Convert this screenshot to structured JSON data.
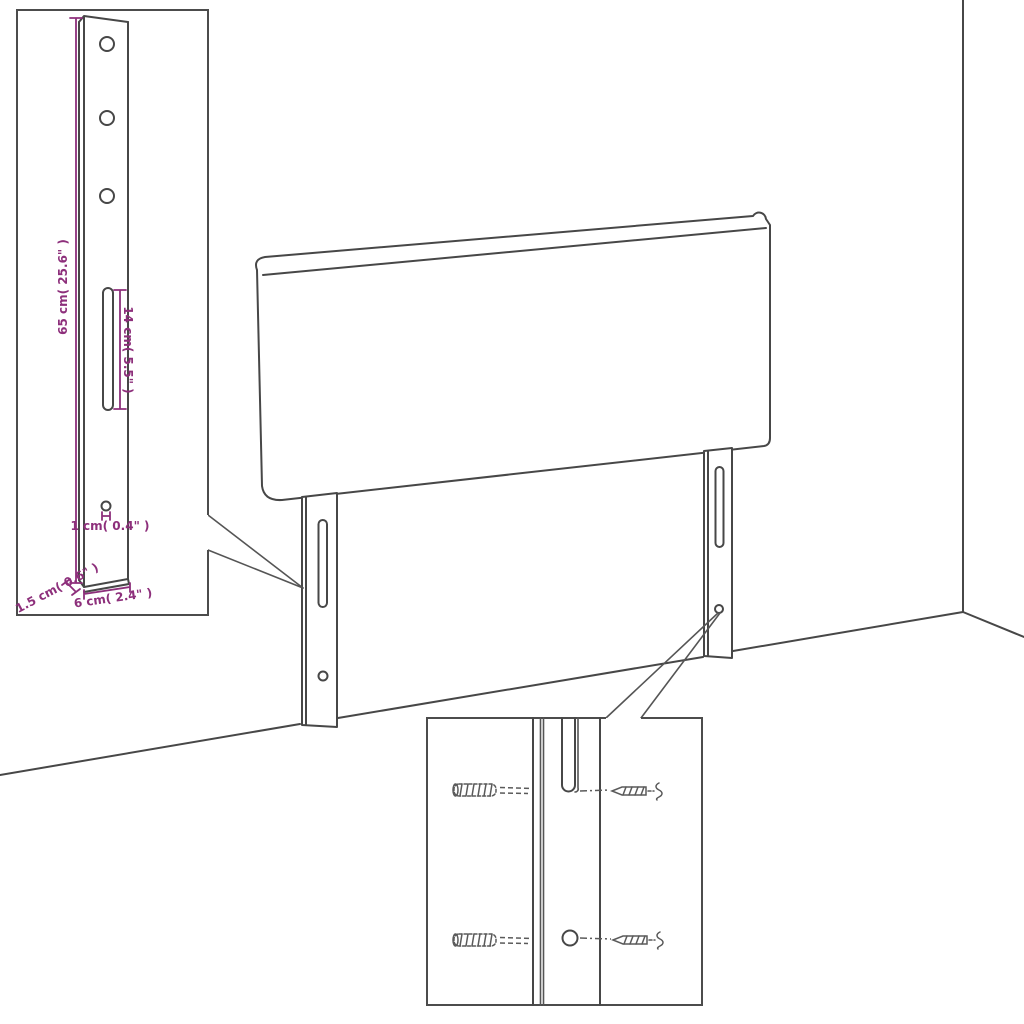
{
  "title": "Headboard mounting dimension diagram",
  "colors": {
    "line": "#474747",
    "dimension": "#8d2f7b",
    "background": "#ffffff"
  },
  "dimension_labels": {
    "leg_height": "65 cm( 25.6\" )",
    "slot_length": "14 cm( 5.5\" )",
    "hole_size": "1 cm( 0.4\" )",
    "leg_depth": "1.5 cm( 0.6\" )",
    "leg_width": "6 cm( 2.4\" )"
  }
}
